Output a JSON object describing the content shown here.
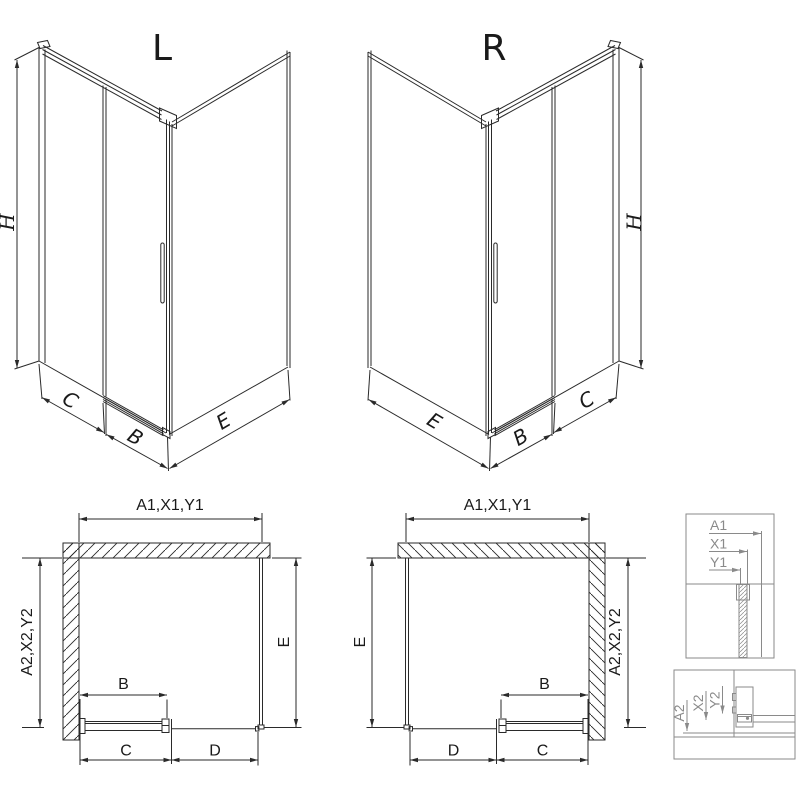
{
  "colors": {
    "background": "#ffffff",
    "line": "#2a2a2a",
    "detail_line": "#8a8a8a"
  },
  "views": {
    "iso_left": {
      "title": "L",
      "dim_height": "H",
      "dim_c": "C",
      "dim_b": "B",
      "dim_e": "E"
    },
    "iso_right": {
      "title": "R",
      "dim_height": "H",
      "dim_e": "E",
      "dim_b": "B",
      "dim_c": "C"
    },
    "plan_left": {
      "dim_top": "A1,X1,Y1",
      "dim_left": "A2,X2,Y2",
      "dim_right": "E",
      "dim_b": "B",
      "dim_c": "C",
      "dim_d": "D"
    },
    "plan_right": {
      "dim_top": "A1,X1,Y1",
      "dim_right": "A2,X2,Y2",
      "dim_left": "E",
      "dim_b": "B",
      "dim_d": "D",
      "dim_c": "C"
    },
    "detail_top": {
      "dim_1": "A1",
      "dim_2": "X1",
      "dim_3": "Y1"
    },
    "detail_bottom": {
      "dim_1": "A2",
      "dim_2": "X2",
      "dim_3": "Y2"
    }
  }
}
